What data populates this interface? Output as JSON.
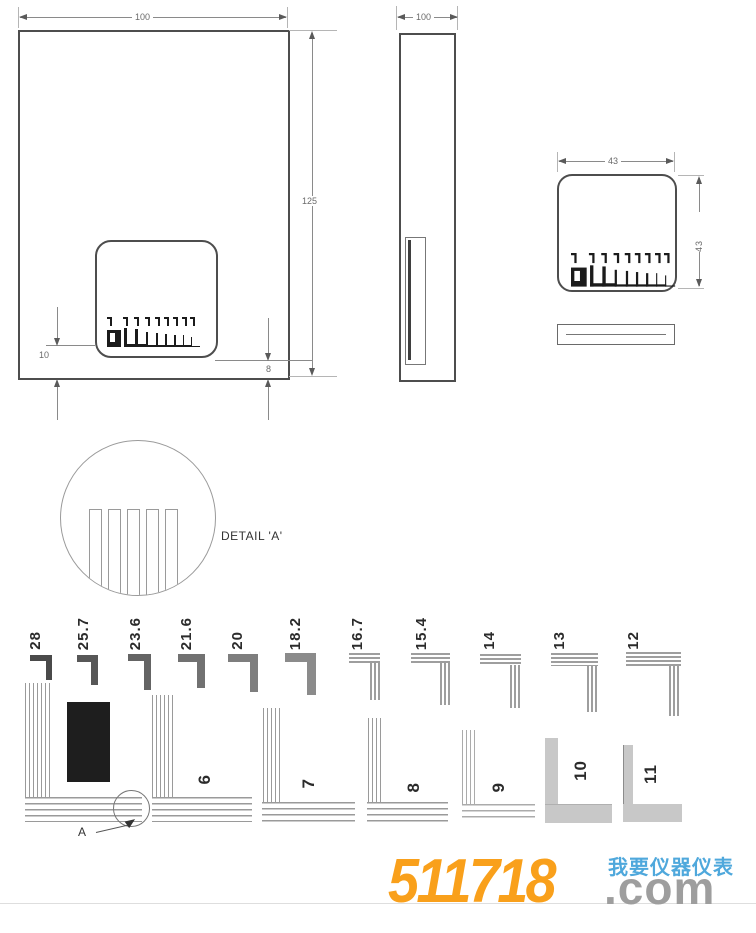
{
  "drawing": {
    "front_view": {
      "width_dim": "100",
      "height_dim": "125",
      "offset_left_dim": "10",
      "offset_right_dim": "8"
    },
    "side_view": {
      "width_dim": "100"
    },
    "card_view": {
      "width_dim": "43",
      "height_dim": "43"
    },
    "detail_view": {
      "title": "DETAIL 'A'",
      "callout_label": "A"
    },
    "pitch_labels": [
      "28",
      "25.7",
      "23.6",
      "21.6",
      "20",
      "18.2",
      "16.7",
      "15.4",
      "14",
      "13",
      "12"
    ],
    "comb_numbers": [
      "6",
      "7",
      "8",
      "9",
      "10",
      "11"
    ]
  },
  "watermark": {
    "number": "511718",
    "tld": ".com",
    "tagline": "我要仪器仪表",
    "colors": {
      "number": "#F9A01B",
      "tld": "#9E9E9E",
      "tagline": "#4FA8DC",
      "rule_line": "#DEDEDE"
    }
  }
}
